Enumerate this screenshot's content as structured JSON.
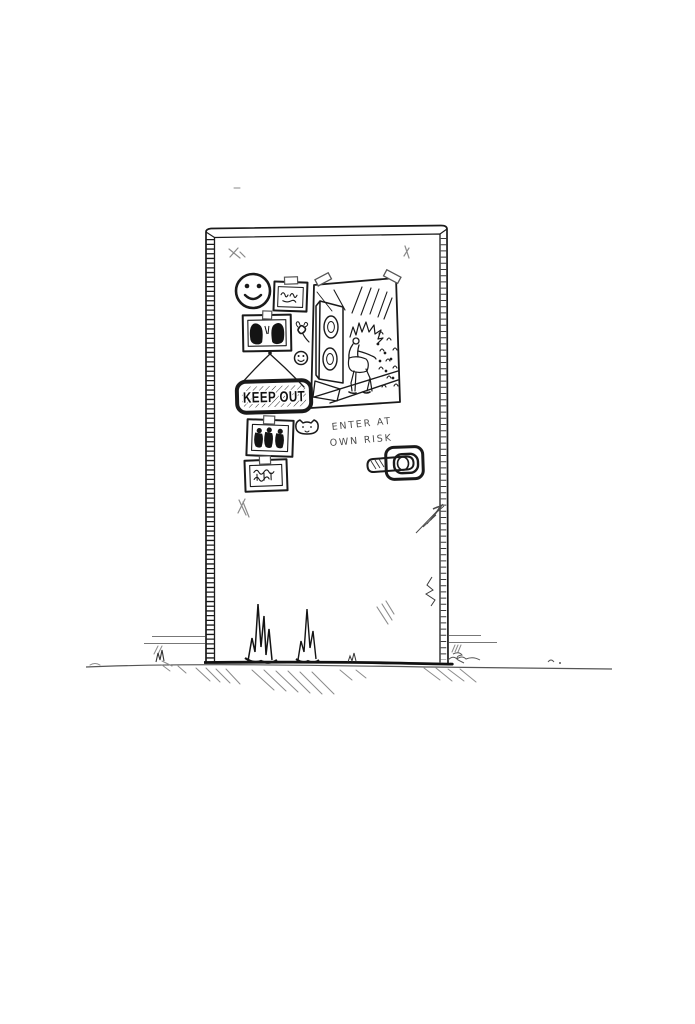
{
  "scene": {
    "description": "Hand-drawn ink sketch of a closed bedroom door decorated with stickers, taped photos, a hanging KEEP OUT sign, a rock-concert poster and a handwritten warning",
    "paper_color": "#ffffff",
    "ink_color": "#1a1a1a",
    "pencil_color": "#8a8a8a"
  },
  "door": {
    "sign": {
      "label": "KEEP OUT"
    },
    "warning": {
      "line1": "ENTER AT",
      "line2": "OWN RISK"
    },
    "stickers": [
      {
        "name": "smiley-face-sticker"
      },
      {
        "name": "fly-sticker"
      },
      {
        "name": "mini-smiley-sticker"
      },
      {
        "name": "cat-face-sticker"
      }
    ],
    "photos": [
      {
        "name": "taped-photo-figures"
      },
      {
        "name": "taped-photo-two-friends"
      },
      {
        "name": "taped-photo-band"
      },
      {
        "name": "taped-photo-scribbles"
      }
    ],
    "poster": {
      "name": "rock-concert-poster"
    },
    "handle": {
      "name": "door-handle"
    }
  }
}
